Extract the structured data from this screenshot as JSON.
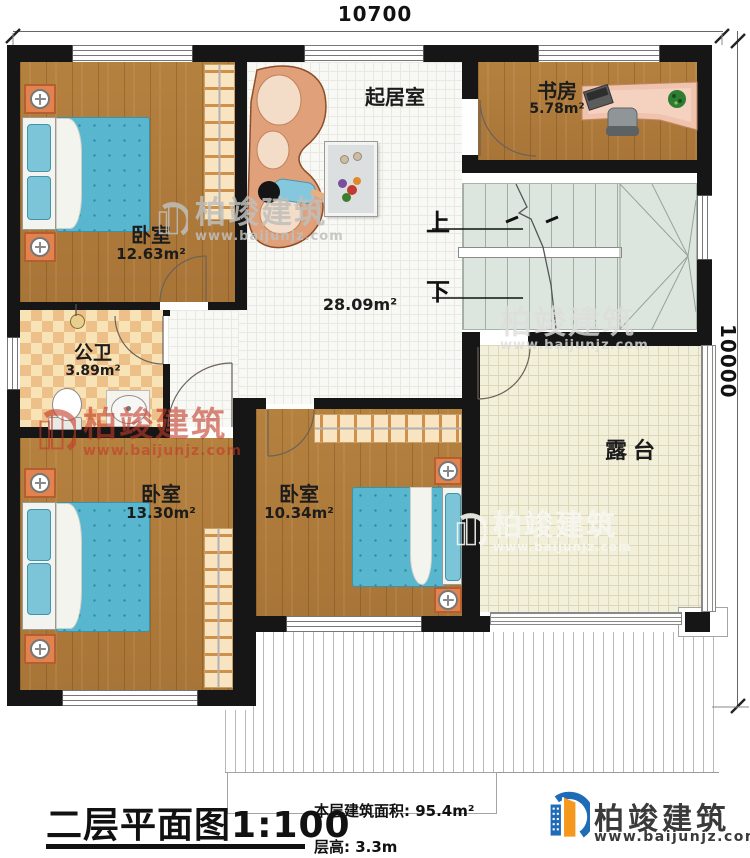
{
  "dimensions": {
    "width_mm": "10700",
    "height_mm": "10000"
  },
  "rooms": {
    "bedroom_tl": {
      "name": "卧室",
      "area": "12.63m²"
    },
    "living": {
      "name": "起居室",
      "area": "28.09m²"
    },
    "study": {
      "name": "书房",
      "area": "5.78m²"
    },
    "bathroom": {
      "name": "公卫",
      "area": "3.89m²"
    },
    "bedroom_bl": {
      "name": "卧室",
      "area": "13.30m²"
    },
    "bedroom_bc": {
      "name": "卧室",
      "area": "10.34m²"
    },
    "terrace": {
      "name": "露台"
    }
  },
  "stairs": {
    "up": "上",
    "down": "下"
  },
  "footer": {
    "title": "二层平面图",
    "scale": "1:100",
    "floor_area": "本层建筑面积: 95.4m²",
    "floor_height": "层高: 3.3m"
  },
  "brand": {
    "name": "柏竣建筑",
    "url": "www.baijunjz.com"
  },
  "colors": {
    "wall": "#161616",
    "wood_floor": "#b07d3e",
    "tile_floor": "#f8f8f4",
    "terrace_floor": "#f2efda",
    "stair_floor": "#dde6de",
    "bath_tile": "#eec089",
    "bed": "#58b6ce",
    "sofa": "#dfa07a",
    "nightstand": "#e2834f",
    "watermark_red": "#c43a28",
    "brand_text": "#3a3a3a",
    "brand_blue": "#1e6bb8",
    "brand_orange": "#f5991e"
  }
}
